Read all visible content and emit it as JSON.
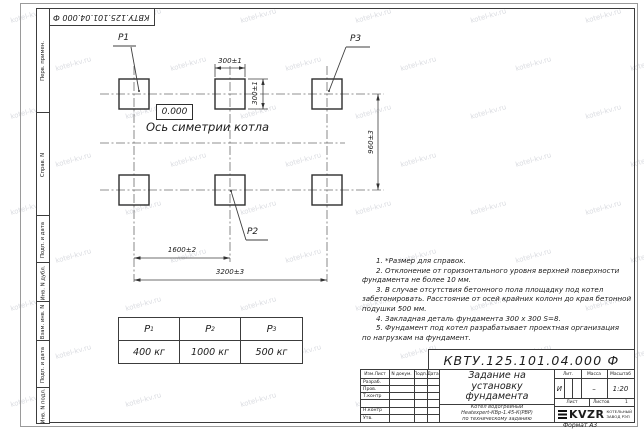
{
  "watermark": {
    "text": "kotel-kv.ru"
  },
  "frame": {
    "top_stamp": "КВТУ.125.101.04.000  Ф",
    "margin_top": [
      {
        "label": "Перв. примен."
      },
      {
        "label": "Справ. N"
      }
    ],
    "margin_bottom": [
      {
        "label": "Подп. и дата"
      },
      {
        "label": "Инв. N дубл."
      },
      {
        "label": "Взам. инв. N"
      },
      {
        "label": "Подп. и дата"
      },
      {
        "label": "Инв. N подл."
      }
    ],
    "format_label": "Формат А3"
  },
  "drawing": {
    "pad_labels": {
      "p1": "P1",
      "p2": "P2",
      "p3": "P3"
    },
    "level_mark": "0.000",
    "axis_label": "Ось симетрии котла",
    "dimensions": {
      "pad_width": "300±1",
      "pad_height": "300±1",
      "row_spacing": "960±3",
      "col_spacing": "1600±2",
      "total_span": "3200±3"
    }
  },
  "notes": {
    "lines": [
      "1. *Размер для справок.",
      "2. Отклонение от горизонтального уровня верхней поверхности",
      "фундамента не более 10 мм.",
      "3. В случае отсутствия бетонного пола площадку под котел",
      "забетонировать. Расстояние от осей крайних колонн до края бетонной",
      "подушки 500 мм.",
      "4. Закладная деталь фундамента  300 х 300  S=8.",
      "5. Фундамент под котел разрабатывает проектная организация",
      "по нагрузкам на фундамент."
    ]
  },
  "load_table": {
    "columns": [
      {
        "symbol": "P",
        "index": "1",
        "value": "400 кг"
      },
      {
        "symbol": "P",
        "index": "2",
        "value": "1000 кг"
      },
      {
        "symbol": "P",
        "index": "3",
        "value": "500 кг"
      }
    ]
  },
  "title_block": {
    "designation": "КВТУ.125.101.04.000  Ф",
    "header_cols": [
      "Изм.Лист",
      "N докум.",
      "Подп.",
      "Дата"
    ],
    "rows": [
      "Разраб.",
      "Пров.",
      "Т.контр",
      "",
      "Н.контр",
      "Утв."
    ],
    "title": [
      "Задание на",
      "установку",
      "фундамента"
    ],
    "subtitle": [
      "Котел водогрейный",
      "Heatexpert-КВр-1.45-К(РВР)",
      "по техническому заданию"
    ],
    "lit_label": "Лит.",
    "lit_value": "И",
    "mass_label": "Масса",
    "mass_value": "–",
    "scale_label": "Масштаб",
    "scale_value": "1:20",
    "sheet_label": "Лист",
    "sheets_label": "Листов",
    "sheets_value": "1",
    "logo_text": "KVZR",
    "logo_caption": [
      "КОТЕЛЬНЫЙ",
      "ЗАВОД РЭП"
    ]
  }
}
